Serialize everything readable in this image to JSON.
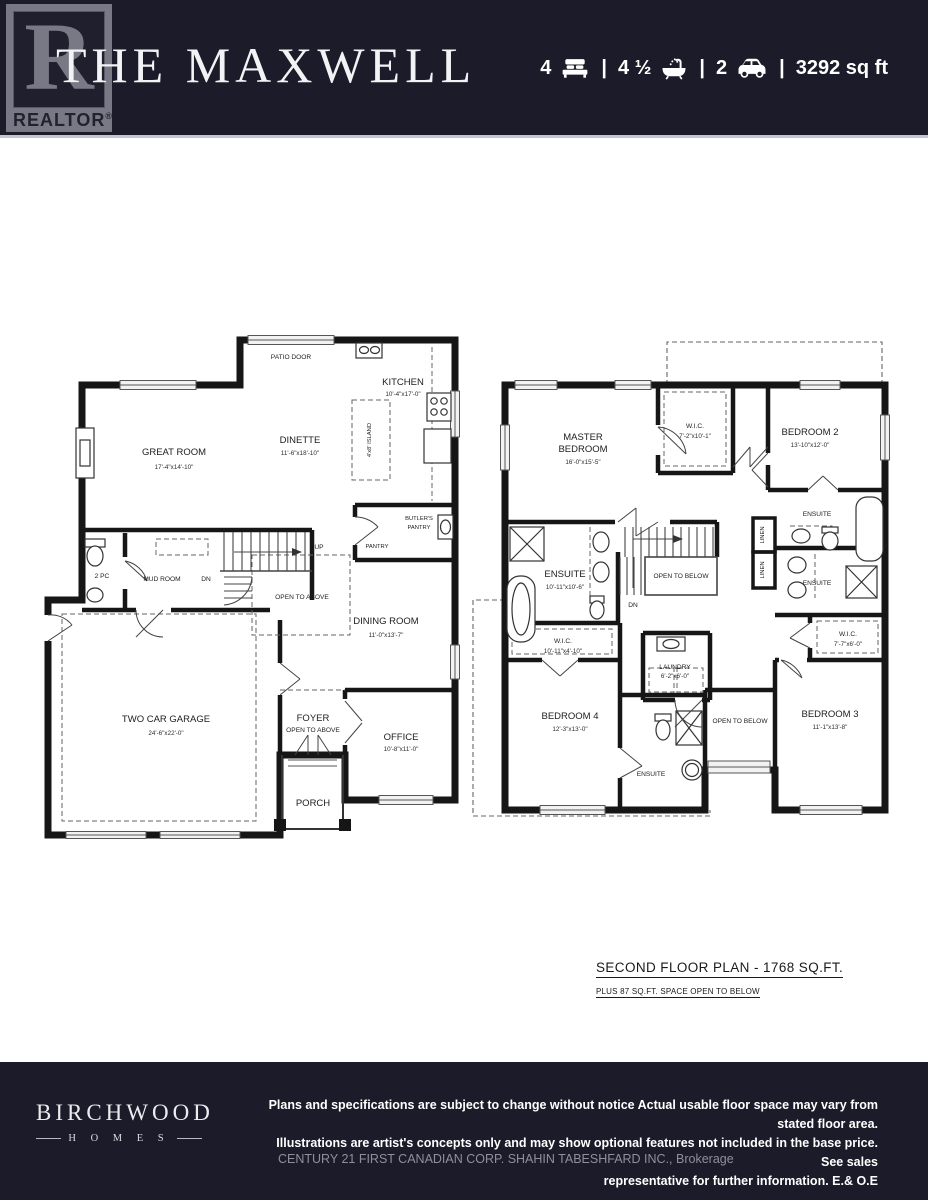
{
  "header": {
    "title": "THE MAXWELL",
    "realtor_logo": "REALTOR",
    "registered_mark": "®",
    "realtor_r": "R",
    "stats": {
      "beds": "4",
      "baths": "4 ½",
      "cars": "2",
      "sqft": "3292 sq ft",
      "sep": "|"
    }
  },
  "first_floor": {
    "patio_door": "PATIO DOOR",
    "kitchen": "KITCHEN",
    "kitchen_dims": "10'-4\"x17'-0\"",
    "island": "4'x8' ISLAND",
    "dinette": "DINETTE",
    "dinette_dims": "11'-6\"x18'-10\"",
    "great_room": "GREAT ROOM",
    "great_room_dims": "17'-4\"x14'-10\"",
    "butlers_1": "BUTLER'S",
    "butlers_2": "PANTRY",
    "pantry": "PANTRY",
    "up": "UP",
    "dn": "DN",
    "open_to_above": "OPEN TO ABOVE",
    "mud_room": "MUD ROOM",
    "two_pc": "2 PC",
    "garage": "TWO CAR GARAGE",
    "garage_dims": "24'-6\"x22'-0\"",
    "dining": "DINING ROOM",
    "dining_dims": "11'-0\"x13'-7\"",
    "foyer": "FOYER",
    "foyer_sub": "OPEN TO ABOVE",
    "office": "OFFICE",
    "office_dims": "10'-8\"x11'-0\"",
    "porch": "PORCH"
  },
  "second_floor": {
    "master_1": "MASTER",
    "master_2": "BEDROOM",
    "master_dims": "16'-0\"x15'-5\"",
    "wic_master": "W.I.C.",
    "wic_master_dims": "7'-2\"x10'-1\"",
    "bedroom2": "BEDROOM 2",
    "bedroom2_dims": "13'-10\"x12'-0\"",
    "ensuite2": "ENSUITE",
    "linen": "LINEN",
    "master_ensuite": "ENSUITE",
    "master_ensuite_dims": "10'-11\"x10'-6\"",
    "open_below_stairs": "OPEN TO BELOW",
    "dn": "DN",
    "ensuite3": "ENSUITE",
    "wic3": "W.I.C.",
    "wic3_dims": "7'-7\"x6'-0\"",
    "wic4": "W.I.C.",
    "wic4_dims": "10'-11\"x4'-10\"",
    "laundry": "LAUNDRY",
    "laundry_dims": "6'-2\"x6'-0\"",
    "bedroom4": "BEDROOM 4",
    "bedroom4_dims": "12'-3\"x13'-0\"",
    "ensuite4": "ENSUITE",
    "open_below_center": "OPEN TO BELOW",
    "bedroom3": "BEDROOM 3",
    "bedroom3_dims": "11'-1\"x13'-8\"",
    "caption": "SECOND FLOOR PLAN - 1768 SQ.FT.",
    "caption_sub": "PLUS 87 SQ.FT. SPACE OPEN TO BELOW"
  },
  "footer": {
    "brand": "BIRCHWOOD",
    "brand_sub": "H O M E S",
    "disclaimer_1": "Plans and specifications are subject to change without notice Actual usable floor space may vary from stated floor area.",
    "disclaimer_2": "Illustrations are artist's concepts only and may show optional features not included in the base price. See sales",
    "disclaimer_3": "representative for further information. E.& O.E",
    "brokerage": "CENTURY 21 FIRST CANADIAN CORP. SHAHIN TABESHFARD INC., Brokerage"
  }
}
